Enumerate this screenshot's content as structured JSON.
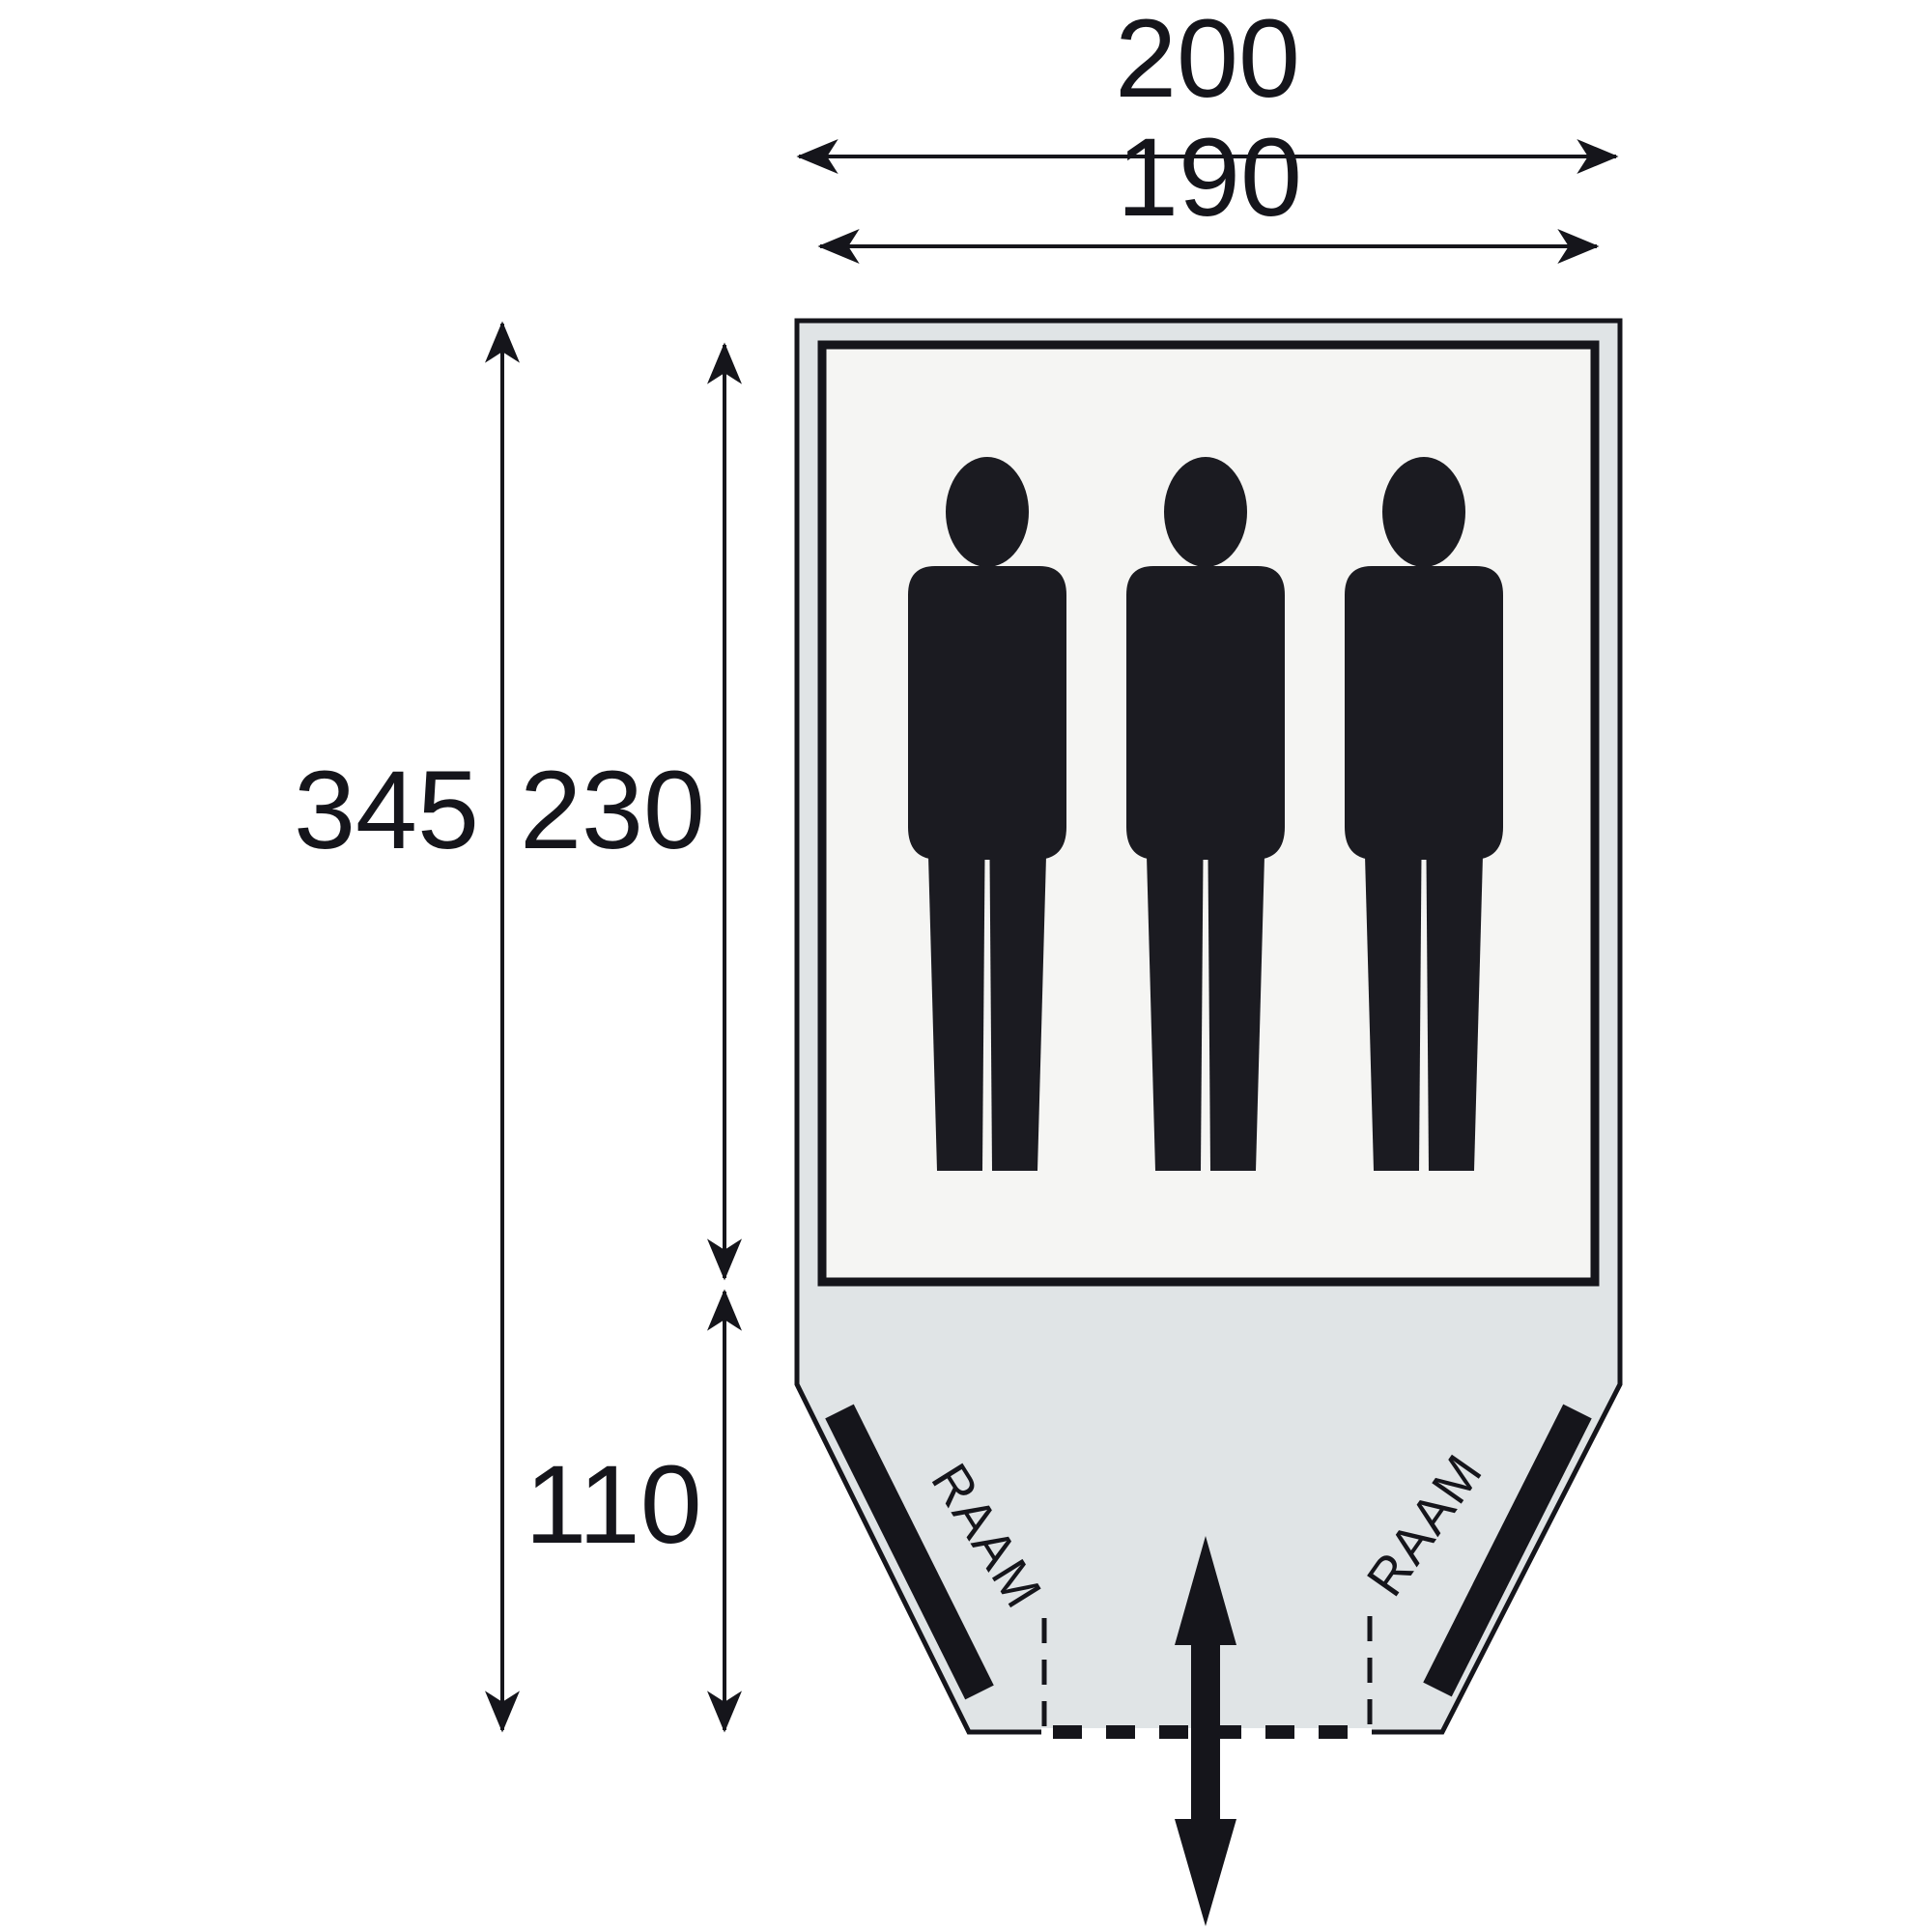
{
  "diagram": {
    "type": "tent-floorplan-top-view",
    "dimensions": {
      "outer_width": "200",
      "inner_width": "190",
      "total_depth": "345",
      "sleeping_cabin_depth": "230",
      "porch_depth": "110"
    },
    "windows": {
      "left_label": "RAAM",
      "right_label": "RAAM"
    },
    "occupants": 3,
    "colors": {
      "line_black": "#15151b",
      "tent_fill": "#e0e4e6",
      "cabin_fill": "#f5f5f3",
      "silhouette": "#1b1b21",
      "background": "#ffffff"
    }
  }
}
